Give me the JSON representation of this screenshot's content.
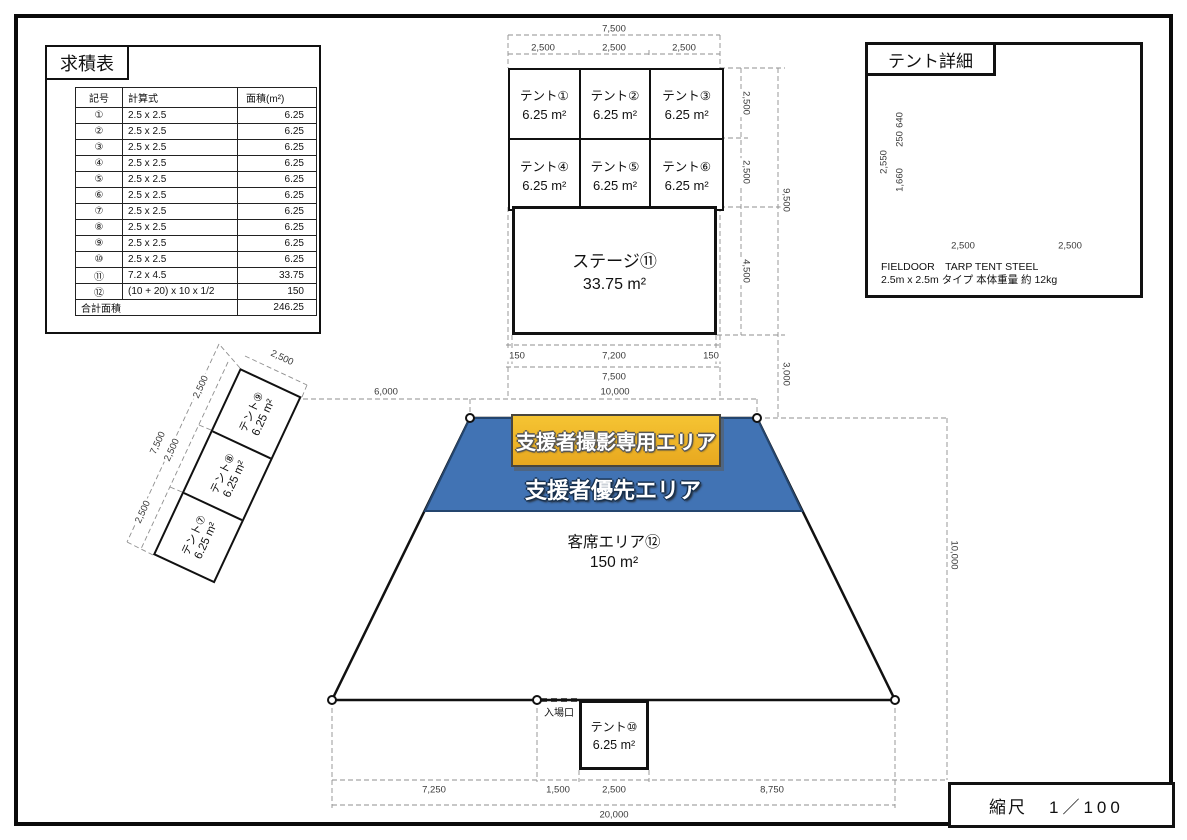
{
  "colors": {
    "blue_area": "#4173b4",
    "blue_border": "#24456e",
    "yellow_top": "#f5c433",
    "yellow_bottom": "#e8a81f",
    "dim_line": "#8f8f8f",
    "ink": "#111111",
    "canopy_left": "#b7ab99",
    "canopy_right": "#a79a85"
  },
  "area_table": {
    "title": "求積表",
    "headers": [
      "記号",
      "計算式",
      "面積(m²)"
    ],
    "rows": [
      [
        "①",
        "2.5 x 2.5",
        "6.25"
      ],
      [
        "②",
        "2.5 x 2.5",
        "6.25"
      ],
      [
        "③",
        "2.5 x 2.5",
        "6.25"
      ],
      [
        "④",
        "2.5 x 2.5",
        "6.25"
      ],
      [
        "⑤",
        "2.5 x 2.5",
        "6.25"
      ],
      [
        "⑥",
        "2.5 x 2.5",
        "6.25"
      ],
      [
        "⑦",
        "2.5 x 2.5",
        "6.25"
      ],
      [
        "⑧",
        "2.5 x 2.5",
        "6.25"
      ],
      [
        "⑨",
        "2.5 x 2.5",
        "6.25"
      ],
      [
        "⑩",
        "2.5 x 2.5",
        "6.25"
      ],
      [
        "⑪",
        "7.2 x 4.5",
        "33.75"
      ],
      [
        "⑫",
        "(10 + 20) x 10 x 1/2",
        "150"
      ]
    ],
    "total_label": "合計面積",
    "total_value": "246.25"
  },
  "tent_detail": {
    "title": "テント詳細",
    "product_line1": "FIELDOOR　TARP TENT STEEL",
    "product_line2": "2.5m x 2.5m タイプ 本体重量 約 12kg"
  },
  "scale_box": {
    "label": "縮尺",
    "value": "1／100"
  },
  "plan": {
    "top_tents": [
      {
        "name": "テント①",
        "area": "6.25 m²"
      },
      {
        "name": "テント②",
        "area": "6.25 m²"
      },
      {
        "name": "テント③",
        "area": "6.25 m²"
      },
      {
        "name": "テント④",
        "area": "6.25 m²"
      },
      {
        "name": "テント⑤",
        "area": "6.25 m²"
      },
      {
        "name": "テント⑥",
        "area": "6.25 m²"
      }
    ],
    "stage": {
      "name": "ステージ⑪",
      "area": "33.75 m²"
    },
    "left_tents": [
      {
        "name": "テント⑨",
        "area": "6.25 m²"
      },
      {
        "name": "テント⑧",
        "area": "6.25 m²"
      },
      {
        "name": "テント⑦",
        "area": "6.25 m²"
      }
    ],
    "bottom_tent": {
      "name": "テント⑩",
      "area": "6.25 m²"
    },
    "audience": {
      "name": "客席エリア⑫",
      "area": "150 m²"
    },
    "photo_area_label": "支援者撮影専用エリア",
    "priority_area_label": "支援者優先エリア",
    "entrance_label": "入場口"
  },
  "dims": [
    {
      "t": "7,500",
      "x": 614,
      "y": 29,
      "r": 0
    },
    {
      "t": "2,500",
      "x": 543,
      "y": 48,
      "r": 0
    },
    {
      "t": "2,500",
      "x": 614,
      "y": 48,
      "r": 0
    },
    {
      "t": "2,500",
      "x": 684,
      "y": 48,
      "r": 0
    },
    {
      "t": "2,500",
      "x": 746,
      "y": 103,
      "r": 90
    },
    {
      "t": "2,500",
      "x": 746,
      "y": 172,
      "r": 90
    },
    {
      "t": "9,500",
      "x": 786,
      "y": 200,
      "r": 90
    },
    {
      "t": "4,500",
      "x": 746,
      "y": 271,
      "r": 90
    },
    {
      "t": "150",
      "x": 517,
      "y": 356,
      "r": 0
    },
    {
      "t": "7,200",
      "x": 614,
      "y": 356,
      "r": 0
    },
    {
      "t": "150",
      "x": 711,
      "y": 356,
      "r": 0
    },
    {
      "t": "7,500",
      "x": 614,
      "y": 377,
      "r": 0
    },
    {
      "t": "10,000",
      "x": 615,
      "y": 392,
      "r": 0
    },
    {
      "t": "6,000",
      "x": 386,
      "y": 392,
      "r": 0
    },
    {
      "t": "3,000",
      "x": 786,
      "y": 374,
      "r": 90
    },
    {
      "t": "10,000",
      "x": 954,
      "y": 555,
      "r": 90
    },
    {
      "t": "7,250",
      "x": 434,
      "y": 790,
      "r": 0
    },
    {
      "t": "1,500",
      "x": 558,
      "y": 790,
      "r": 0
    },
    {
      "t": "2,500",
      "x": 614,
      "y": 790,
      "r": 0
    },
    {
      "t": "8,750",
      "x": 772,
      "y": 790,
      "r": 0
    },
    {
      "t": "20,000",
      "x": 614,
      "y": 815,
      "r": 0
    },
    {
      "t": "2,500",
      "x": 282,
      "y": 358,
      "r": 25
    },
    {
      "t": "2,500",
      "x": 201,
      "y": 387,
      "r": -65
    },
    {
      "t": "2,500",
      "x": 172,
      "y": 450,
      "r": -65
    },
    {
      "t": "2,500",
      "x": 143,
      "y": 512,
      "r": -65
    },
    {
      "t": "7,500",
      "x": 158,
      "y": 443,
      "r": -65
    },
    {
      "t": "2,550",
      "x": 884,
      "y": 162,
      "r": -90
    },
    {
      "t": "640",
      "x": 900,
      "y": 120,
      "r": -90
    },
    {
      "t": "250",
      "x": 900,
      "y": 139,
      "r": -90
    },
    {
      "t": "1,660",
      "x": 900,
      "y": 180,
      "r": -90
    },
    {
      "t": "2,500",
      "x": 963,
      "y": 246,
      "r": 0
    },
    {
      "t": "2,500",
      "x": 1070,
      "y": 246,
      "r": 0
    }
  ]
}
